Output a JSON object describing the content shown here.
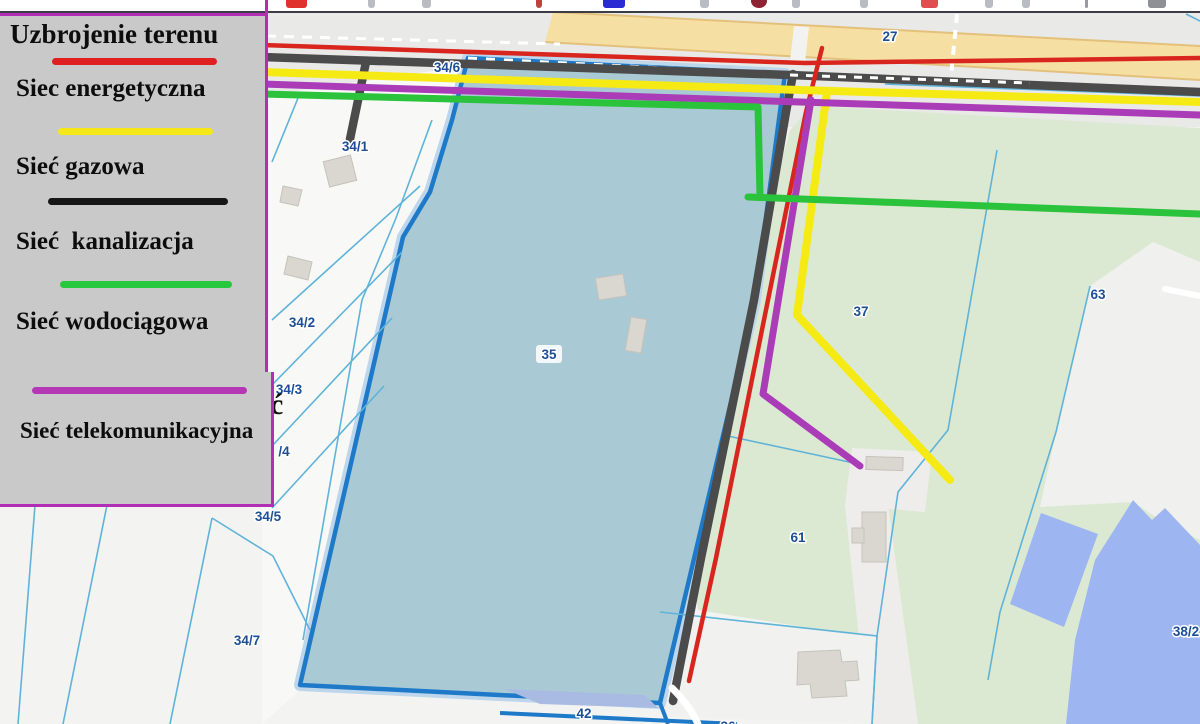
{
  "legend": {
    "title": "Uzbrojenie terenu",
    "items": [
      {
        "label": "Siec energetyczna",
        "color": "#e02020"
      },
      {
        "label": "Sieć gazowa",
        "color": "#f5e718"
      },
      {
        "label": "Sieć  kanalizacja",
        "color": "#161616"
      },
      {
        "label": "Sieć wodociągowa",
        "color": "#27c83e"
      },
      {
        "label": "Sieć telekomunikacyjna",
        "color": "#b437b4"
      }
    ]
  },
  "map": {
    "parcel_labels": [
      {
        "id": "27",
        "x": 890,
        "y": 41
      },
      {
        "id": "34/6",
        "x": 447,
        "y": 72
      },
      {
        "id": "34/1",
        "x": 355,
        "y": 151
      },
      {
        "id": "34/2",
        "x": 302,
        "y": 327
      },
      {
        "id": "34/3",
        "x": 289,
        "y": 394
      },
      {
        "id": "/4",
        "x": 284,
        "y": 456
      },
      {
        "id": "34/5",
        "x": 268,
        "y": 521
      },
      {
        "id": "34/7",
        "x": 247,
        "y": 645
      },
      {
        "id": "35",
        "x": 549,
        "y": 359,
        "chip": true
      },
      {
        "id": "37",
        "x": 861,
        "y": 316
      },
      {
        "id": "63",
        "x": 1098,
        "y": 299
      },
      {
        "id": "61",
        "x": 798,
        "y": 542
      },
      {
        "id": "38/2",
        "x": 1186,
        "y": 636
      },
      {
        "id": "42",
        "x": 584,
        "y": 718
      },
      {
        "id": "36",
        "x": 728,
        "y": 731
      }
    ],
    "stray_text": "ć",
    "utility_colors": {
      "energy": "#d8261e",
      "gas": "#f6ea14",
      "sewer": "#4b4b4b",
      "water": "#2bc23c",
      "telecom": "#ab3cb8"
    },
    "fill_colors": {
      "parcel_35": "#a9cad4",
      "green_area": "#dbe9d2",
      "water": "#9db6f2",
      "tan_road": "#f6dfa3"
    }
  },
  "toolbar": {
    "icons": [
      {
        "name": "red-app-icon",
        "x": 286,
        "w": 21,
        "color": "#e0312d"
      },
      {
        "name": "glyph",
        "x": 368,
        "w": 7,
        "color": "#b9bcc2"
      },
      {
        "name": "glyph",
        "x": 422,
        "w": 9,
        "color": "#b9bcc2"
      },
      {
        "name": "small-red-glyph",
        "x": 536,
        "w": 6,
        "color": "#c04040"
      },
      {
        "name": "blue-app-icon",
        "x": 603,
        "w": 22,
        "color": "#2b2bd4"
      },
      {
        "name": "glyph",
        "x": 700,
        "w": 9,
        "color": "#b9bcc2"
      },
      {
        "name": "dark-red-circle-icon",
        "x": 751,
        "w": 16,
        "color": "#8e2433"
      },
      {
        "name": "glyph",
        "x": 792,
        "w": 8,
        "color": "#b9bcc2"
      },
      {
        "name": "glyph",
        "x": 860,
        "w": 8,
        "color": "#b9bcc2"
      },
      {
        "name": "red-badge-icon",
        "x": 921,
        "w": 17,
        "color": "#e04e50"
      },
      {
        "name": "glyph",
        "x": 985,
        "w": 8,
        "color": "#b9bcc2"
      },
      {
        "name": "glyph",
        "x": 1022,
        "w": 8,
        "color": "#b9bcc2"
      },
      {
        "name": "divider",
        "x": 1085,
        "w": 3,
        "color": "#9a9aa2"
      },
      {
        "name": "printer-icon",
        "x": 1148,
        "w": 18,
        "color": "#8f8f96"
      }
    ]
  }
}
